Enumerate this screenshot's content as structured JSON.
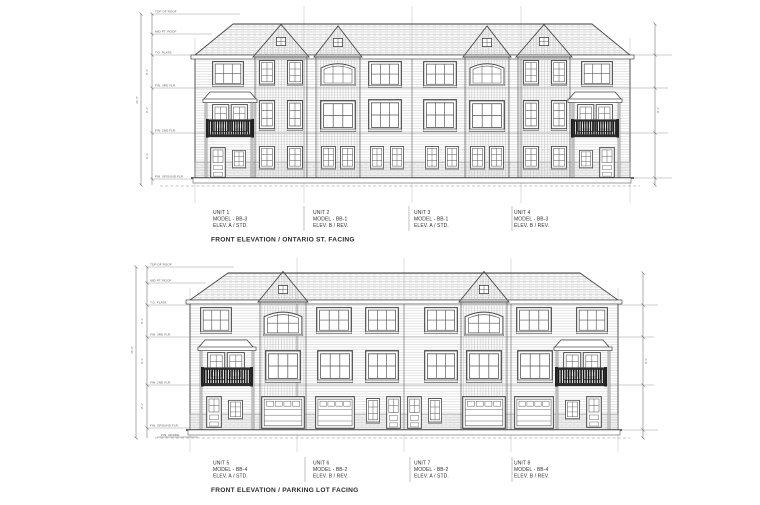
{
  "colors": {
    "paper": "#ffffff",
    "line": "#474747",
    "line_light": "#9a9a9a",
    "hatch": "#c9c9c9",
    "railing": "#1f1f1f",
    "dim_text": "#5a5a5a"
  },
  "dims": {
    "storey": "9'-1\"",
    "upper_storey": "8'-1\"",
    "overall": "31'-6\""
  },
  "elevations": [
    {
      "id": "ontario",
      "title": "FRONT ELEVATION / ONTARIO ST. FACING",
      "units": [
        {
          "name": "UNIT 1",
          "model": "MODEL - BB-3",
          "elev": "ELEV. A / STD."
        },
        {
          "name": "UNIT 2",
          "model": "MODEL - BB-1",
          "elev": "ELEV. B / REV."
        },
        {
          "name": "UNIT 3",
          "model": "MODEL - BB-1",
          "elev": "ELEV. A / STD."
        },
        {
          "name": "UNIT 4",
          "model": "MODEL - BB-3",
          "elev": "ELEV. B / REV."
        }
      ],
      "levels": [
        "TOP OF ROOF",
        "MID PT. ROOF",
        "T.O. PLATE",
        "FIN. 3RD FLR.",
        "FIN. 2ND FLR.",
        "FIN. GROUND FLR."
      ]
    },
    {
      "id": "parking",
      "title": "FRONT ELEVATION / PARKING LOT FACING",
      "units": [
        {
          "name": "UNIT 5",
          "model": "MODEL - BB-4",
          "elev": "ELEV. A / STD."
        },
        {
          "name": "UNIT 6",
          "model": "MODEL - BB-2",
          "elev": "ELEV. B / REV."
        },
        {
          "name": "UNIT 7",
          "model": "MODEL - BB-2",
          "elev": "ELEV. A / STD."
        },
        {
          "name": "UNIT 8",
          "model": "MODEL - BB-4",
          "elev": "ELEV. B / REV."
        }
      ],
      "levels": [
        "TOP OF ROOF",
        "MID PT. ROOF",
        "T.O. PLATE",
        "FIN. 3RD FLR.",
        "FIN. 2ND FLR.",
        "FIN. GROUND FLR."
      ],
      "grade_label": "FIN. GRADE"
    }
  ]
}
